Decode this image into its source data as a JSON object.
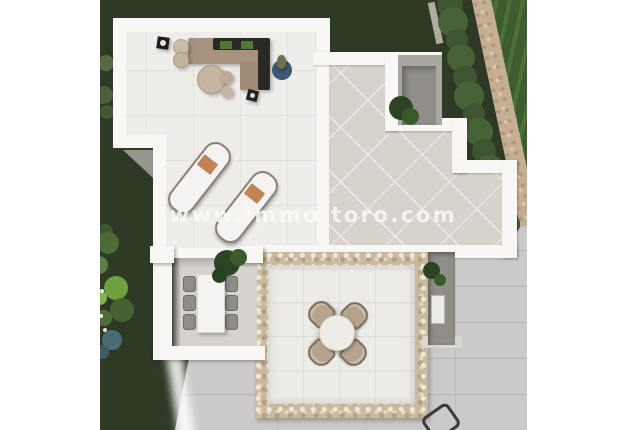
{
  "watermark": {
    "text": "www.immo-toro.com"
  },
  "scene": {
    "description": "aerial-3d-render-of-villa-roof-terrace-and-garden",
    "objects": [
      "corner-sofa",
      "sun-loungers",
      "coffee-tables",
      "poufs",
      "blue-rug",
      "dining-table-indoor",
      "dining-chairs",
      "round-table-outdoor",
      "outdoor-chairs",
      "hedge",
      "gravel-path",
      "lawn",
      "pebble-terrace",
      "courtyard-tree"
    ]
  },
  "colors": {
    "grass-dark": "#2e3926",
    "lawn-bright": "#3e5d2e",
    "lawn-stripe": "#4c7036",
    "hedge-a": "#3d5530",
    "hedge-b": "#486238",
    "gravel": "#c4ae94",
    "gravel-dot": "#b09878",
    "wall": "#f8f7f5",
    "floor-upper": "#efedea",
    "tile-diag": "#d8d2cd",
    "paving": "#cbc9ca",
    "pebble": "#c9b9a0",
    "pebble-floor": "#edebe7",
    "pergola-floor": "#d6d3cf",
    "shadow": "#53514b",
    "sofa": "#a6927e",
    "sofa-dark": "#2a2925",
    "cushion-green": "#4e7a35",
    "wood-beige": "#c6b5a0",
    "lounger": "#f4f3f1",
    "lounger-frame": "#8a8177",
    "towel": "#c08355",
    "rug-blue": "#3d5875",
    "pot-olive": "#70704e",
    "chair-grey": "#8f8d88",
    "chair-beige": "#b5a38d",
    "plant-dark": "#2c4423",
    "plant-mid": "#3a5a2c",
    "courtyard": "#aaa7a3",
    "courtyard-inner": "#918e8a",
    "watermark": "rgba(250,250,248,0.82)"
  },
  "garden": {
    "bushes": [
      {
        "x": 5,
        "y": 232,
        "r": 8,
        "c": "#40582f"
      },
      {
        "x": 8,
        "y": 243,
        "r": 11,
        "c": "#4c6b37"
      },
      {
        "x": -1,
        "y": 265,
        "r": 9,
        "c": "#5d8040"
      },
      {
        "x": 16,
        "y": 288,
        "r": 12,
        "c": "#6fa23f"
      },
      {
        "x": 0,
        "y": 298,
        "r": 7,
        "c": "#87b053"
      },
      {
        "x": 22,
        "y": 310,
        "r": 12,
        "c": "#456332"
      },
      {
        "x": 4,
        "y": 318,
        "r": 8,
        "c": "#4e7038"
      },
      {
        "x": 12,
        "y": 340,
        "r": 10,
        "c": "#4a6d74"
      },
      {
        "x": 2,
        "y": 352,
        "r": 7,
        "c": "#3f5a64"
      },
      {
        "x": 6,
        "y": 63,
        "r": 8,
        "c": "rgba(118,148,95,0.55)"
      },
      {
        "x": 4,
        "y": 95,
        "r": 9,
        "c": "rgba(104,134,84,0.5)"
      },
      {
        "x": 7,
        "y": 112,
        "r": 7,
        "c": "rgba(96,126,80,0.45)"
      }
    ],
    "flowers": [
      {
        "x": 2,
        "y": 291,
        "r": 2,
        "c": "#e8ecdf"
      },
      {
        "x": 1,
        "y": 316,
        "r": 2,
        "c": "#e8ecdf"
      },
      {
        "x": 5,
        "y": 330,
        "r": 2,
        "c": "#dfe5d4"
      },
      {
        "x": -2,
        "y": 276,
        "r": 2,
        "c": "#e8ecdf"
      }
    ],
    "hedge": [
      {
        "x": 350,
        "y": 5,
        "r": 13
      },
      {
        "x": 353,
        "y": 22,
        "r": 15
      },
      {
        "x": 357,
        "y": 40,
        "r": 11
      },
      {
        "x": 361,
        "y": 58,
        "r": 14
      },
      {
        "x": 365,
        "y": 77,
        "r": 12
      },
      {
        "x": 369,
        "y": 96,
        "r": 15
      },
      {
        "x": 374,
        "y": 114,
        "r": 11
      },
      {
        "x": 379,
        "y": 132,
        "r": 14
      },
      {
        "x": 384,
        "y": 151,
        "r": 12
      },
      {
        "x": 390,
        "y": 170,
        "r": 15
      },
      {
        "x": 396,
        "y": 189,
        "r": 11
      },
      {
        "x": 402,
        "y": 207,
        "r": 13
      },
      {
        "x": 408,
        "y": 224,
        "r": 12
      }
    ]
  }
}
